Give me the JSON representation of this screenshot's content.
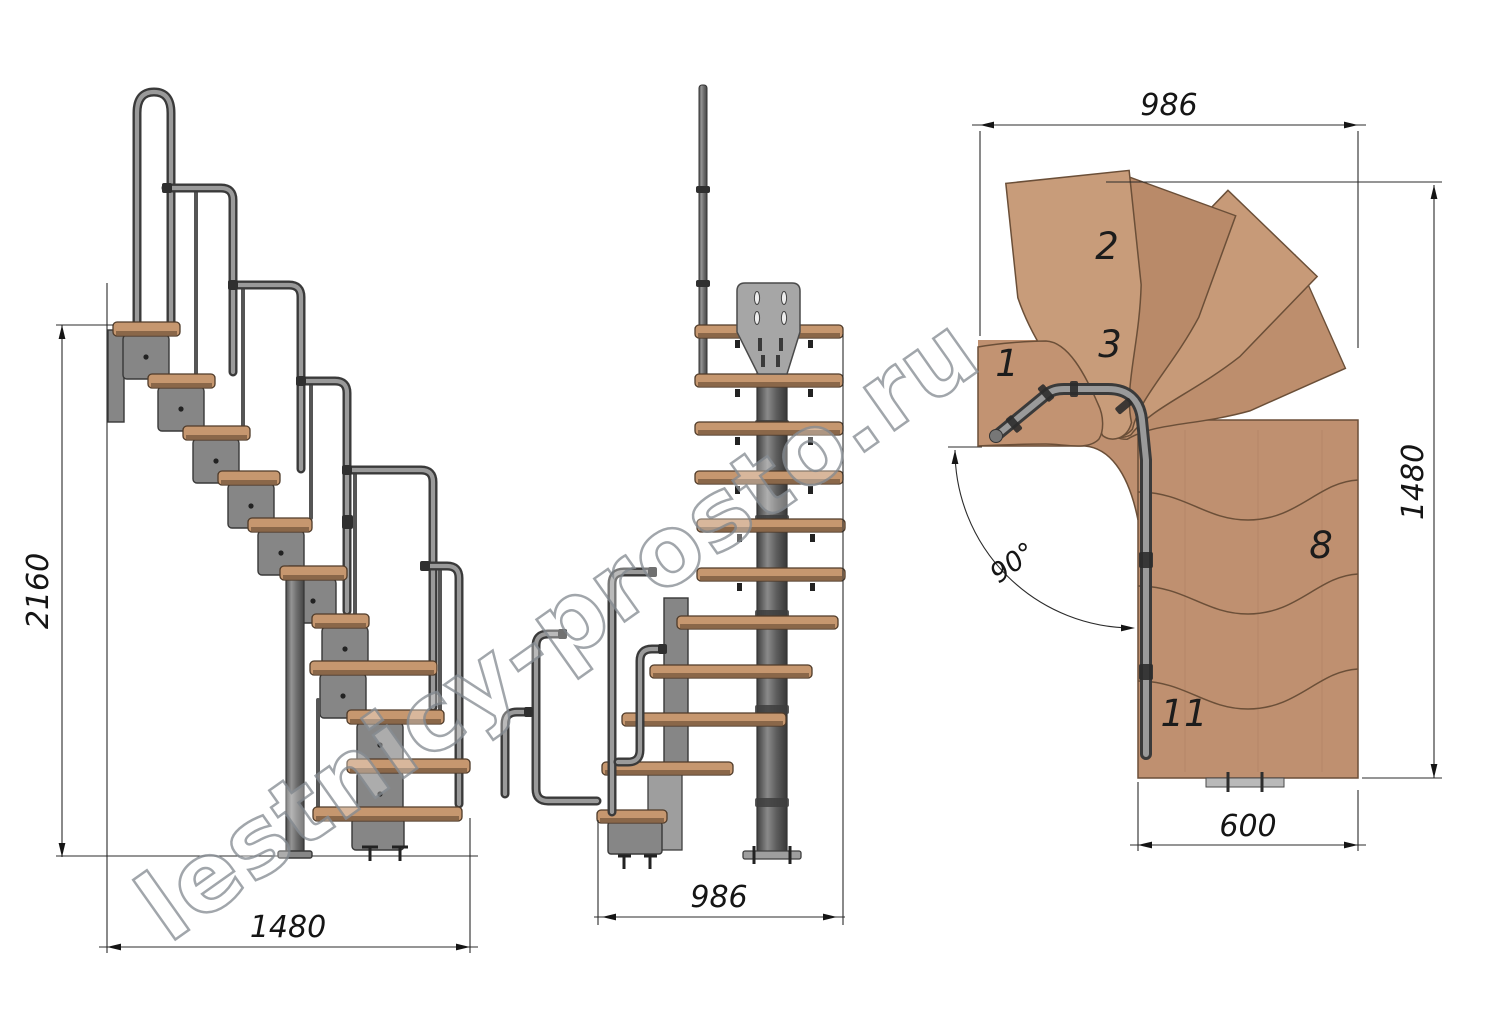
{
  "watermark": "lestnicy-prosto.ru",
  "side_view": {
    "height_mm": "2160",
    "length_mm": "1480"
  },
  "front_view": {
    "width_mm": "986"
  },
  "plan_view": {
    "width_top_mm": "986",
    "depth_mm": "1480",
    "flight_width_mm": "600",
    "turn_angle": "90°",
    "step_numbers": {
      "s1": "1",
      "s2": "2",
      "s3": "3",
      "s8": "8",
      "s11": "11"
    }
  },
  "colors": {
    "background": "#ffffff",
    "wood": "#c6976f",
    "wood_plan": "#bf9070",
    "metal": "#868686",
    "metal_dark": "#3a3a3a",
    "dimension_lines": "#2b2b2b",
    "watermark_outline": "#878d93"
  }
}
